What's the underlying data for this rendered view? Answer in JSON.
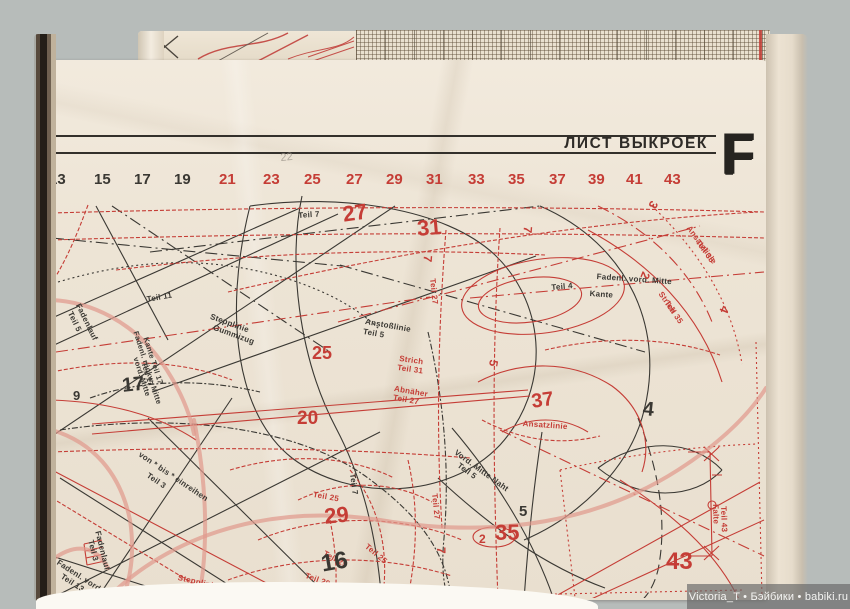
{
  "header": {
    "title": "ЛИСТ ВЫКРОЕК",
    "sheet_letter": "F"
  },
  "watermark": {
    "text": "Victoria_T • Бэйбики • babiki.ru"
  },
  "colors": {
    "red": "#c53d36",
    "black": "#3a3833",
    "pink": "#e09a8e",
    "paper": "#ede4d5",
    "bg": "#b7bcba",
    "pencil": "#9b948a"
  },
  "ruler": {
    "numbers": [
      {
        "t": "13",
        "c": "black",
        "x": 49
      },
      {
        "t": "15",
        "c": "black",
        "x": 94
      },
      {
        "t": "17",
        "c": "black",
        "x": 134
      },
      {
        "t": "19",
        "c": "black",
        "x": 174
      },
      {
        "t": "21",
        "c": "red",
        "x": 219
      },
      {
        "t": "23",
        "c": "red",
        "x": 263
      },
      {
        "t": "25",
        "c": "red",
        "x": 304
      },
      {
        "t": "27",
        "c": "red",
        "x": 346
      },
      {
        "t": "29",
        "c": "red",
        "x": 386
      },
      {
        "t": "31",
        "c": "red",
        "x": 426
      },
      {
        "t": "33",
        "c": "red",
        "x": 468
      },
      {
        "t": "35",
        "c": "red",
        "x": 508
      },
      {
        "t": "37",
        "c": "red",
        "x": 549
      },
      {
        "t": "39",
        "c": "red",
        "x": 588
      },
      {
        "t": "41",
        "c": "red",
        "x": 626
      },
      {
        "t": "43",
        "c": "red",
        "x": 664
      }
    ]
  },
  "annotations": [
    {
      "t": "Teil 7",
      "x": 298,
      "y": 211,
      "r": -4,
      "c": "black",
      "s": 8,
      "k": "label"
    },
    {
      "t": "Teil 11",
      "x": 146,
      "y": 295,
      "r": -10,
      "c": "black",
      "s": 8,
      "k": "label"
    },
    {
      "t": "Fadenlauf",
      "x": 82,
      "y": 302,
      "r": 64,
      "c": "black",
      "s": 8,
      "k": "label"
    },
    {
      "t": "Teil 5",
      "x": 74,
      "y": 310,
      "r": 64,
      "c": "black",
      "s": 8,
      "k": "label"
    },
    {
      "t": "Stepplinie",
      "x": 212,
      "y": 312,
      "r": 20,
      "c": "black",
      "s": 8,
      "k": "label"
    },
    {
      "t": "Gummizug",
      "x": 215,
      "y": 323,
      "r": 20,
      "c": "black",
      "s": 8,
      "k": "label"
    },
    {
      "t": "Fadenl. rückw. Mitte",
      "x": 140,
      "y": 330,
      "r": 72,
      "c": "black",
      "s": 7.5,
      "k": "label"
    },
    {
      "t": "Kante Teil 17",
      "x": 150,
      "y": 336,
      "r": 72,
      "c": "black",
      "s": 7.5,
      "k": "label"
    },
    {
      "t": "Anstoßlinie",
      "x": 366,
      "y": 317,
      "r": 10,
      "c": "black",
      "s": 8,
      "k": "label"
    },
    {
      "t": "Teil 5",
      "x": 364,
      "y": 327,
      "r": 10,
      "c": "black",
      "s": 8,
      "k": "label"
    },
    {
      "t": "Teil 4",
      "x": 551,
      "y": 283,
      "r": -5,
      "c": "black",
      "s": 8,
      "k": "label"
    },
    {
      "t": "Fadenl. vord. Mitte",
      "x": 597,
      "y": 272,
      "r": 4,
      "c": "black",
      "s": 8,
      "k": "label"
    },
    {
      "t": "Kante",
      "x": 590,
      "y": 289,
      "r": 4,
      "c": "black",
      "s": 8,
      "k": "label"
    },
    {
      "t": "vord. Mitte",
      "x": 140,
      "y": 356,
      "r": 72,
      "c": "black",
      "s": 7.5,
      "k": "label"
    },
    {
      "t": "Teil 17",
      "x": 148,
      "y": 361,
      "r": 72,
      "c": "black",
      "s": 7.5,
      "k": "label"
    },
    {
      "t": "von * bis * einreihen",
      "x": 142,
      "y": 450,
      "r": 34,
      "c": "black",
      "s": 8,
      "k": "label"
    },
    {
      "t": "Teil 3",
      "x": 150,
      "y": 471,
      "r": 34,
      "c": "black",
      "s": 8,
      "k": "label"
    },
    {
      "t": "Fadenlauf",
      "x": 102,
      "y": 530,
      "r": 76,
      "c": "black",
      "s": 8,
      "k": "label"
    },
    {
      "t": "Teil 3",
      "x": 95,
      "y": 539,
      "r": 76,
      "c": "black",
      "s": 8,
      "k": "label"
    },
    {
      "t": "Fadenl. vord.",
      "x": 60,
      "y": 558,
      "r": 33,
      "c": "black",
      "s": 8,
      "k": "label"
    },
    {
      "t": "Teil 13",
      "x": 64,
      "y": 572,
      "r": 33,
      "c": "black",
      "s": 8,
      "k": "label"
    },
    {
      "t": "Vord. Mitte Naht",
      "x": 458,
      "y": 448,
      "r": 36,
      "c": "black",
      "s": 8,
      "k": "label"
    },
    {
      "t": "Teil 5",
      "x": 461,
      "y": 461,
      "r": 36,
      "c": "black",
      "s": 8,
      "k": "label"
    },
    {
      "t": "Teil 7",
      "x": 357,
      "y": 473,
      "r": 83,
      "c": "black",
      "s": 8,
      "k": "label"
    },
    {
      "t": "Teil 27",
      "x": 437,
      "y": 278,
      "r": 84,
      "c": "red",
      "s": 8,
      "k": "label"
    },
    {
      "t": "Strich",
      "x": 400,
      "y": 354,
      "r": 8,
      "c": "red",
      "s": 8,
      "k": "label"
    },
    {
      "t": "Teil 31",
      "x": 398,
      "y": 363,
      "r": 8,
      "c": "red",
      "s": 8,
      "k": "label"
    },
    {
      "t": "Abnäher",
      "x": 395,
      "y": 384,
      "r": 10,
      "c": "red",
      "s": 8,
      "k": "label"
    },
    {
      "t": "Teil 27",
      "x": 394,
      "y": 393,
      "r": 10,
      "c": "red",
      "s": 8,
      "k": "label"
    },
    {
      "t": "Ansatzlinie",
      "x": 523,
      "y": 419,
      "r": 4,
      "c": "red",
      "s": 8,
      "k": "label"
    },
    {
      "t": "Ansatzlinie",
      "x": 692,
      "y": 224,
      "r": 54,
      "c": "red",
      "s": 8,
      "k": "label"
    },
    {
      "t": "Teil 35",
      "x": 701,
      "y": 238,
      "r": 54,
      "c": "red",
      "s": 8,
      "k": "label"
    },
    {
      "t": "Strich",
      "x": 664,
      "y": 290,
      "r": 55,
      "c": "red",
      "s": 8,
      "k": "label"
    },
    {
      "t": "Teil 35",
      "x": 670,
      "y": 299,
      "r": 55,
      "c": "red",
      "s": 8,
      "k": "label"
    },
    {
      "t": "Stepplinie",
      "x": 179,
      "y": 573,
      "r": 13,
      "c": "red",
      "s": 8,
      "k": "label"
    },
    {
      "t": "Teil 24",
      "x": 177,
      "y": 584,
      "r": 13,
      "c": "red",
      "s": 8,
      "k": "label"
    },
    {
      "t": "Teil 25",
      "x": 314,
      "y": 490,
      "r": 10,
      "c": "red",
      "s": 8,
      "k": "label"
    },
    {
      "t": "Teil 25",
      "x": 369,
      "y": 542,
      "r": 40,
      "c": "red",
      "s": 8,
      "k": "label"
    },
    {
      "t": "Teil 29",
      "x": 326,
      "y": 549,
      "r": 28,
      "c": "red",
      "s": 8,
      "k": "label"
    },
    {
      "t": "Teil 29",
      "x": 307,
      "y": 571,
      "r": 20,
      "c": "red",
      "s": 8,
      "k": "label"
    },
    {
      "t": "Teil 28",
      "x": 297,
      "y": 589,
      "r": 12,
      "c": "red",
      "s": 8,
      "k": "label"
    },
    {
      "t": "Teil 27",
      "x": 439,
      "y": 493,
      "r": 84,
      "c": "red",
      "s": 8,
      "k": "label"
    },
    {
      "t": "Falte",
      "x": 720,
      "y": 504,
      "r": 88,
      "c": "red",
      "s": 8,
      "k": "label"
    },
    {
      "t": "Teil 43",
      "x": 728,
      "y": 506,
      "r": 88,
      "c": "red",
      "s": 8,
      "k": "label"
    },
    {
      "t": "22",
      "x": 280,
      "y": 152,
      "r": -5,
      "c": "pencil",
      "s": 11,
      "k": "pencil"
    },
    {
      "t": "27",
      "x": 341,
      "y": 202,
      "r": -8,
      "c": "red",
      "s": 22,
      "k": "number"
    },
    {
      "t": "31",
      "x": 416,
      "y": 216,
      "r": -5,
      "c": "red",
      "s": 22,
      "k": "number"
    },
    {
      "t": "25",
      "x": 312,
      "y": 343,
      "r": 0,
      "c": "red",
      "s": 18,
      "k": "number"
    },
    {
      "t": "20",
      "x": 297,
      "y": 408,
      "r": 0,
      "c": "red",
      "s": 19,
      "k": "number"
    },
    {
      "t": "17",
      "x": 121,
      "y": 375,
      "r": -6,
      "c": "black",
      "s": 20,
      "k": "number"
    },
    {
      "t": "9",
      "x": 73,
      "y": 388,
      "r": 0,
      "c": "black",
      "s": 13,
      "k": "number"
    },
    {
      "t": "37",
      "x": 530,
      "y": 391,
      "r": -8,
      "c": "red",
      "s": 20,
      "k": "number"
    },
    {
      "t": "4",
      "x": 644,
      "y": 398,
      "r": 6,
      "c": "black",
      "s": 20,
      "k": "number"
    },
    {
      "t": "29",
      "x": 323,
      "y": 504,
      "r": -6,
      "c": "red",
      "s": 22,
      "k": "number"
    },
    {
      "t": "35",
      "x": 495,
      "y": 520,
      "r": 0,
      "c": "red",
      "s": 22,
      "k": "number"
    },
    {
      "t": "16",
      "x": 319,
      "y": 551,
      "r": -10,
      "c": "black",
      "s": 24,
      "k": "number"
    },
    {
      "t": "43",
      "x": 666,
      "y": 548,
      "r": 0,
      "c": "red",
      "s": 24,
      "k": "number"
    },
    {
      "t": "5",
      "x": 519,
      "y": 503,
      "r": 0,
      "c": "black",
      "s": 15,
      "k": "number"
    },
    {
      "t": "2",
      "x": 479,
      "y": 532,
      "r": 0,
      "c": "red",
      "s": 12,
      "k": "number"
    },
    {
      "t": "7",
      "x": 535,
      "y": 227,
      "r": 95,
      "c": "red",
      "s": 12,
      "k": "number"
    },
    {
      "t": "7",
      "x": 435,
      "y": 256,
      "r": 95,
      "c": "red",
      "s": 12,
      "k": "number"
    },
    {
      "t": "3",
      "x": 661,
      "y": 205,
      "r": 118,
      "c": "red",
      "s": 12,
      "k": "number"
    },
    {
      "t": "2",
      "x": 653,
      "y": 275,
      "r": 112,
      "c": "red",
      "s": 12,
      "k": "number"
    },
    {
      "t": "4",
      "x": 732,
      "y": 309,
      "r": 112,
      "c": "red",
      "s": 12,
      "k": "number"
    },
    {
      "t": "5",
      "x": 501,
      "y": 361,
      "r": 100,
      "c": "red",
      "s": 12,
      "k": "number"
    },
    {
      "t": "7",
      "x": 448,
      "y": 547,
      "r": 90,
      "c": "red",
      "s": 12,
      "k": "number"
    }
  ]
}
